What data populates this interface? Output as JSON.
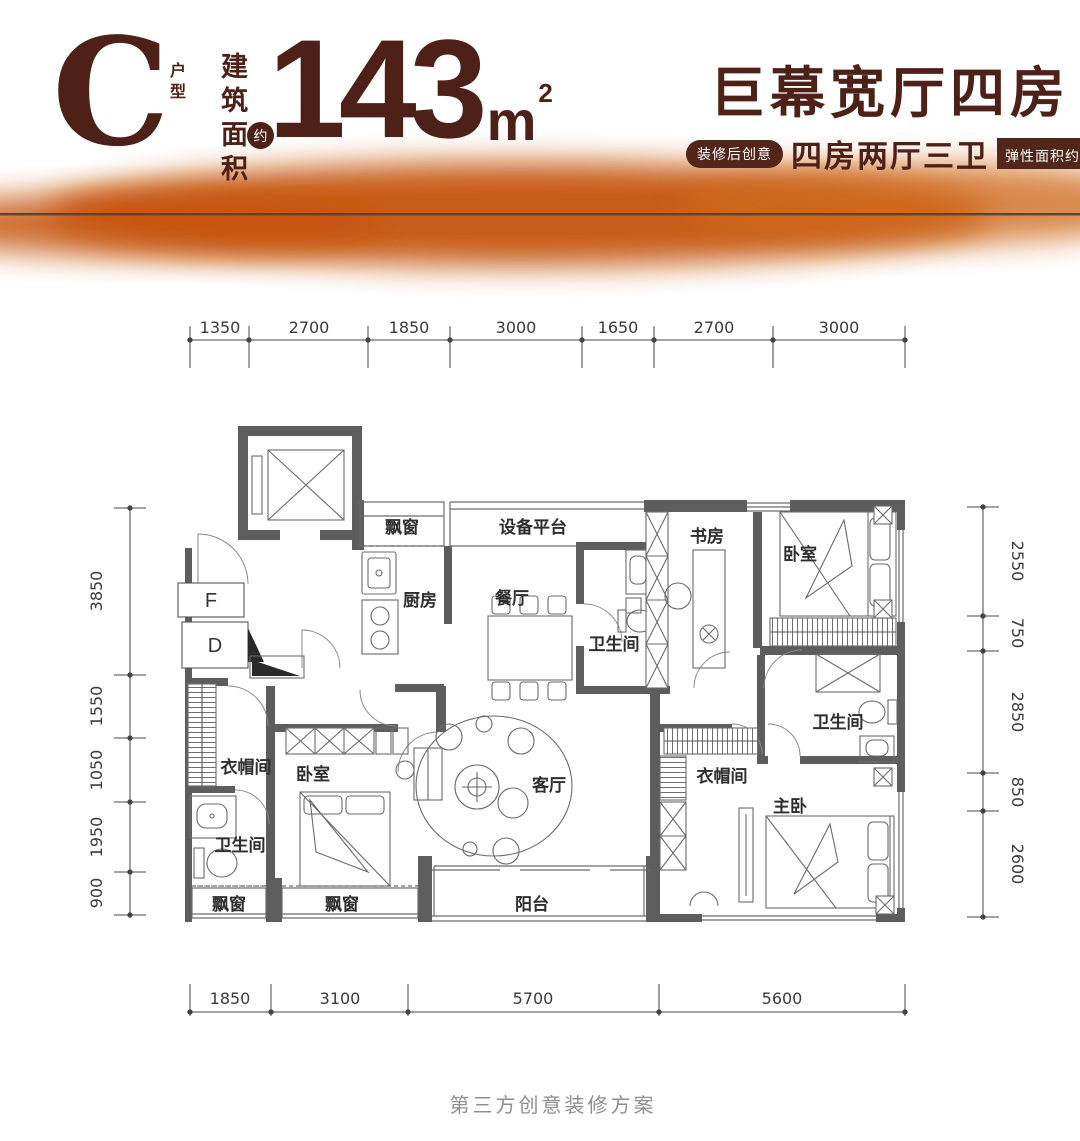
{
  "header": {
    "unit": "C",
    "unit_type": "户型",
    "area_label": "建筑面积",
    "area_approx": "约",
    "area_value": "143",
    "area_unit": "m",
    "area_sup": "2",
    "title": "巨幕宽厅四房",
    "badge_left": "装修后创意",
    "subtitle": "四房两厅三卫",
    "badge_right_prefix": "弹性面积约",
    "badge_right_value": "36",
    "badge_right_unit": "m",
    "badge_right_sup": "2"
  },
  "colors": {
    "brand_brown": "#4e2118",
    "badge_bg": "#52261a",
    "accent_orange": "#c65410",
    "wall_gray": "#5d5d5d",
    "footer_gray": "#8f8f8f"
  },
  "plan": {
    "rooms": {
      "bay_top": "飘窗",
      "equipment": "设备平台",
      "kitchen": "厨房",
      "dining": "餐厅",
      "bath_mid": "卫生间",
      "study": "书房",
      "bedroom_top": "卧室",
      "bath_right": "卫生间",
      "cloak_right": "衣帽间",
      "master": "主卧",
      "living": "客厅",
      "balcony": "阳台",
      "bedroom_left": "卧室",
      "cloak_left": "衣帽间",
      "bath_left": "卫生间",
      "bay_b1": "飘窗",
      "bay_b2": "飘窗"
    },
    "markers": {
      "f": "F",
      "d": "D"
    },
    "dims_top": [
      "1350",
      "2700",
      "1850",
      "3000",
      "1650",
      "2700",
      "3000"
    ],
    "dims_bottom": [
      "1850",
      "3100",
      "5700",
      "5600"
    ],
    "dims_left": [
      "3850",
      "1550",
      "1050",
      "1950",
      "900"
    ],
    "dims_right": [
      "2550",
      "750",
      "2850",
      "850",
      "2600"
    ]
  },
  "footer": {
    "note": "第三方创意装修方案"
  }
}
